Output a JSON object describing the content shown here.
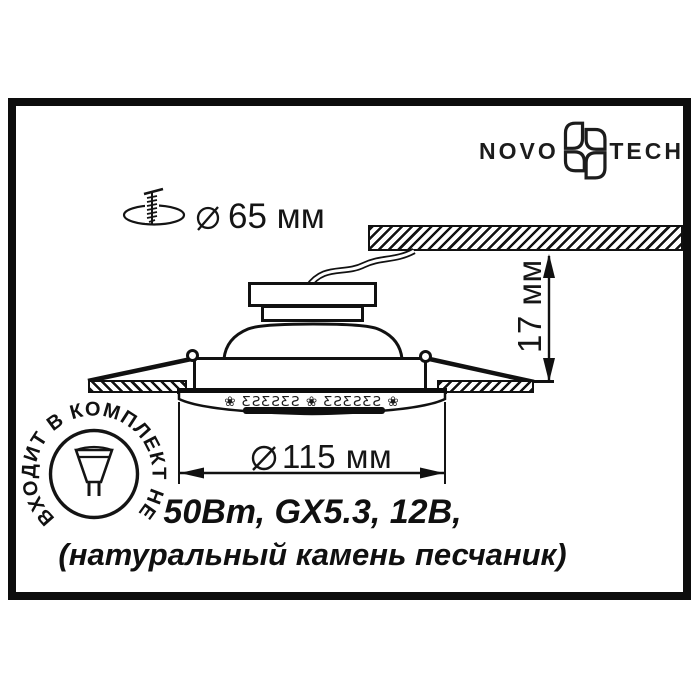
{
  "colors": {
    "ink": "#111111",
    "bg": "#ffffff"
  },
  "logo": {
    "left": "NOVO",
    "right": "TECH"
  },
  "cutout_dimension": {
    "value": "65 мм"
  },
  "diameter_dimension": {
    "value": "115 мм"
  },
  "height_dimension": {
    "value": "17 мм"
  },
  "stamp": {
    "circular_text": "ВХОДИТ В КОМПЛЕКТ НЕ"
  },
  "decor": {
    "ornament_row": "❀ ƸƧƸƧƸƧ ❀ ƸƧƸƧƸƧ ❀"
  },
  "specs": {
    "line1": "50Вт, GX5.3, 12В,",
    "line2": "(натуральный камень песчаник)"
  }
}
